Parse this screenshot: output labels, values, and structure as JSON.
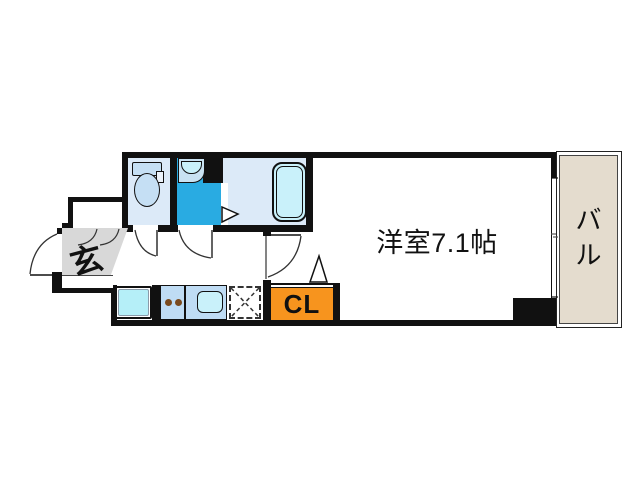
{
  "plan": {
    "rooms": {
      "main_room": {
        "label": "洋室7.1帖"
      },
      "entrance": {
        "label": "玄"
      },
      "closet": {
        "label": "CL"
      },
      "balcony": {
        "chars": [
          "バ",
          "ル"
        ]
      }
    },
    "colors": {
      "wall": "#111111",
      "unit_floor_light": "#DCEAF8",
      "washroom_blue": "#29ABE2",
      "fixture_blue": "#C5DFF4",
      "water_cyan": "#C9F1FA",
      "laundry_pan_cyan": "#B5EFF8",
      "kitchen_counter": "#BFDCF4",
      "closet_orange": "#F7941E",
      "entrance_gray": "#D8D8D8",
      "balcony_beige": "#E4DCCE"
    }
  }
}
